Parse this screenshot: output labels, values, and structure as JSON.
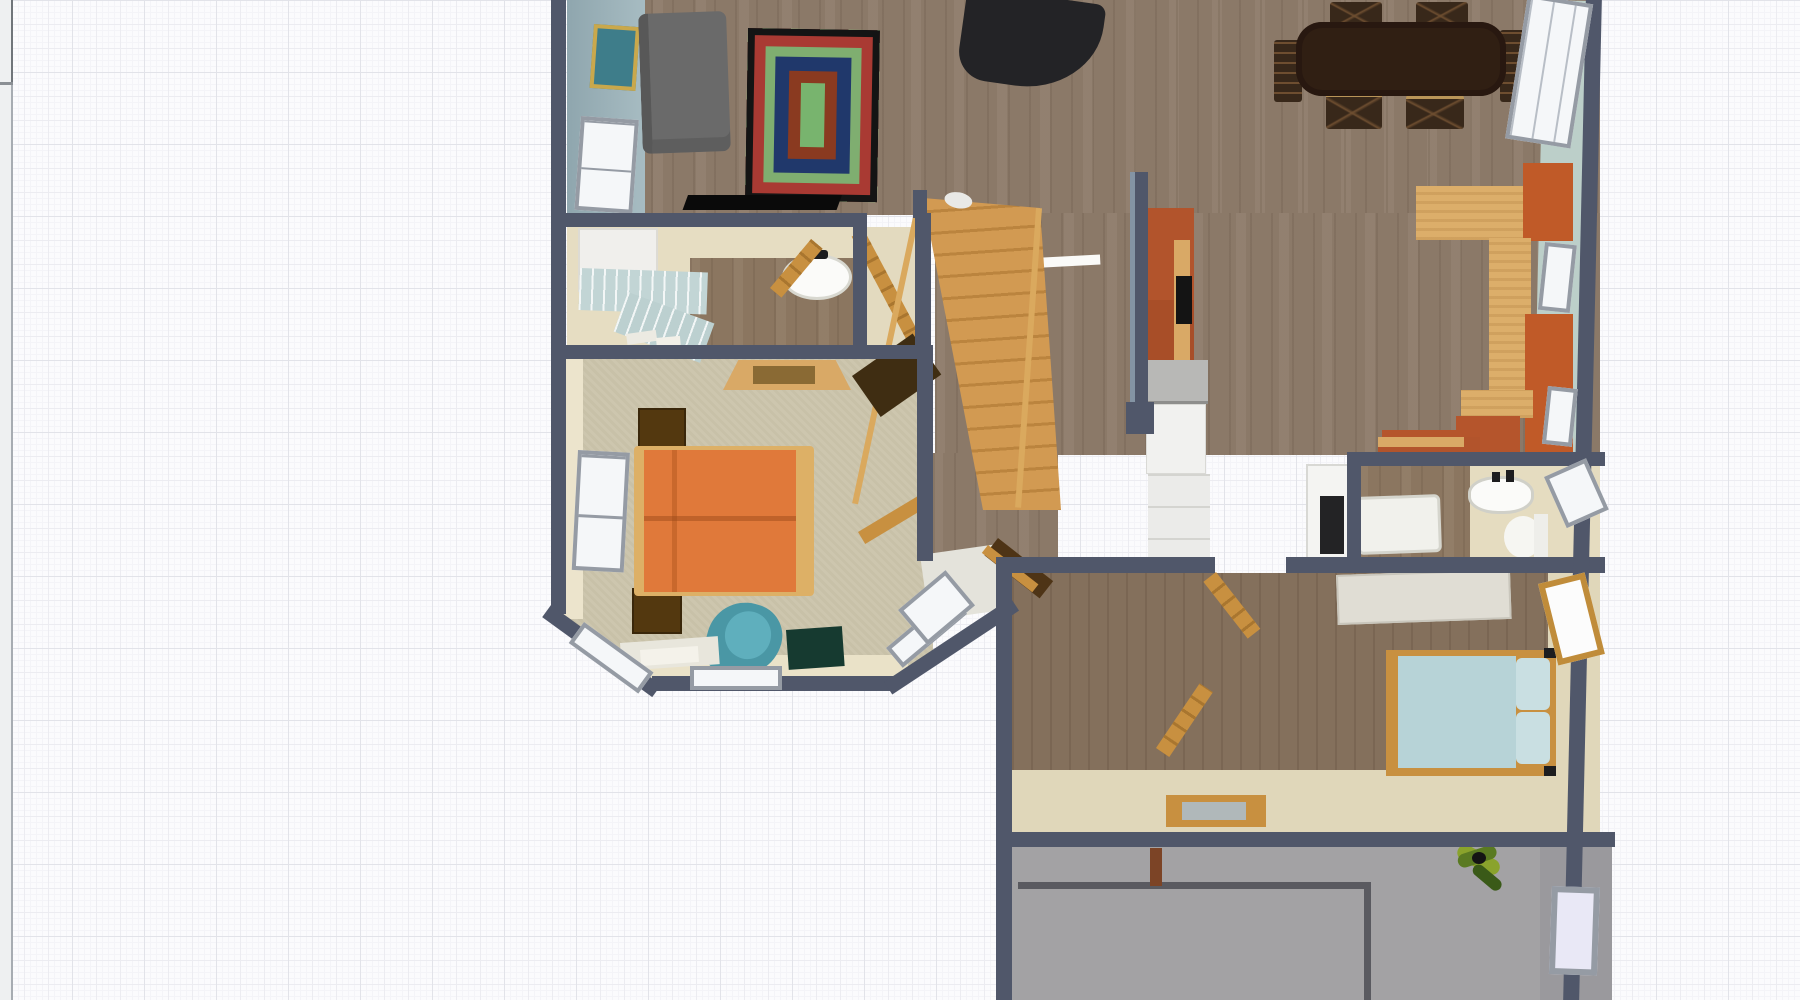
{
  "app": {
    "view": "3d-floor-plan-top-view",
    "background": "graph-paper-grid",
    "left_panel_divider": true,
    "visible_text": []
  },
  "palette": {
    "grid_major": "#e2e3e9",
    "grid_minor": "#f4f4f8",
    "wall": "#50576a",
    "wood_floor": "#8b7968",
    "carpet": "#cdc6ae",
    "concrete": "#a3a2a4",
    "cream_wall": "#e7dfc6",
    "teal_wall": "#bccfc9",
    "blue_wall": "#9db3bb",
    "accent_orange": "#e0793a",
    "sofa_rust": "#c05a28",
    "stair_wood": "#d09850",
    "door_tan": "#c89040",
    "guest_bed_blue": "#b7d3d7"
  },
  "rooms": [
    {
      "id": "living-room",
      "floor": "wood",
      "furniture": [
        "gray-sofa",
        "layered-area-rug",
        "flat-tv",
        "wall-picture",
        "window"
      ]
    },
    {
      "id": "dining-area",
      "floor": "wood",
      "furniture": [
        "grand-piano",
        "dining-table",
        "dining-chairs x6",
        "orange-sectional-sofa",
        "windows x3"
      ]
    },
    {
      "id": "kitchen",
      "floor": "wood",
      "furniture": [
        "orange-upper-cabinets",
        "microwave-nook",
        "gray-counter",
        "refrigerator-counter-run",
        "white-counter-bar"
      ]
    },
    {
      "id": "hall-bathroom",
      "floor": "cream+wood",
      "furniture": [
        "white-cabinet",
        "tiled-blue-counter",
        "wall-sink",
        "open-door",
        "closet-open-door"
      ]
    },
    {
      "id": "staircase-hall",
      "floor": "wood",
      "furniture": [
        "staircase",
        "coat-bench",
        "landing-tile",
        "bay-landing-window"
      ]
    },
    {
      "id": "master-bedroom",
      "floor": "carpet",
      "furniture": [
        "orange-double-bed",
        "nightstand x2",
        "ceiling-fixture",
        "corner-desk",
        "wall-shelf",
        "teal-armchair",
        "green-ottoman",
        "floor-mats",
        "left-window",
        "bay-windows x3"
      ]
    },
    {
      "id": "bathroom",
      "floor": "wood+cream",
      "furniture": [
        "oven",
        "orange-cabinet",
        "bathtub",
        "sink",
        "toilet",
        "window"
      ]
    },
    {
      "id": "guest-bedroom",
      "floor": "wood",
      "furniture": [
        "blue-double-bed",
        "pillows x2",
        "white-dresser",
        "gold-frame-window",
        "open-door x2",
        "threshold"
      ]
    },
    {
      "id": "garage",
      "floor": "concrete",
      "furniture": [
        "garage-door-outline",
        "potted-plant",
        "window",
        "door-trim"
      ]
    }
  ],
  "counts": {
    "windows_total": 11,
    "doors_open": 5,
    "dining_chairs": 6,
    "beds": 2,
    "bathROOM_fixtures": 5
  }
}
